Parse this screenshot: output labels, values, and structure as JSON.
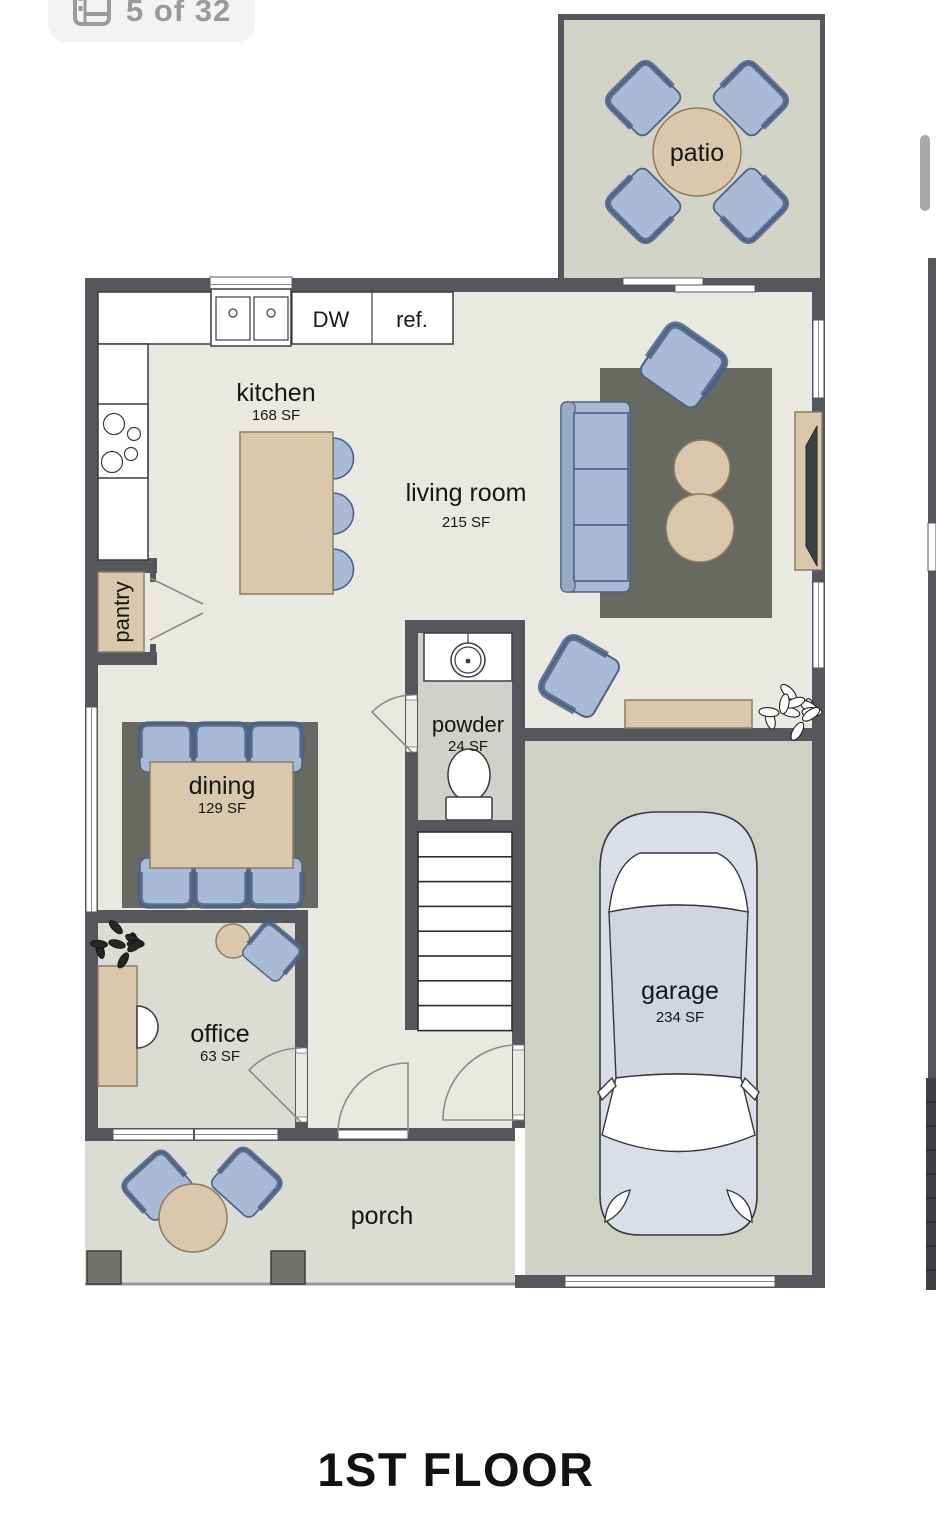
{
  "gallery": {
    "photo_counter": "5 of 32",
    "icon": "floorplan-gallery-icon"
  },
  "plan": {
    "title": "1ST FLOOR",
    "rooms": {
      "patio": {
        "label": "patio"
      },
      "kitchen": {
        "label": "kitchen",
        "area": "168 SF"
      },
      "living": {
        "label": "living room",
        "area": "215 SF"
      },
      "pantry": {
        "label": "pantry"
      },
      "dining": {
        "label": "dining",
        "area": "129 SF"
      },
      "powder": {
        "label": "powder",
        "area": "24 SF"
      },
      "office": {
        "label": "office",
        "area": "63 SF"
      },
      "garage": {
        "label": "garage",
        "area": "234 SF"
      },
      "porch": {
        "label": "porch"
      }
    },
    "fixtures": {
      "dishwasher": "DW",
      "refrigerator": "ref."
    }
  },
  "colors": {
    "wall": "#55575d",
    "floor-cream": "#eae9e1",
    "floor-sage": "#d2d4c7",
    "floor-garage": "#cfd1c4",
    "floor-gray": "#dbdcd4",
    "floor-powder": "#d1d1cb",
    "rug": "#686a61",
    "furniture-blue": "#a9bad7",
    "furniture-blue-dark": "#4e6285",
    "furniture-tan": "#d9c8ab",
    "furniture-tan-dark": "#8d7c5e",
    "car-body": "#dadee7",
    "badge-bg": "#f3f3f4",
    "badge-text": "#9a9a9a",
    "label-text": "#161616"
  }
}
